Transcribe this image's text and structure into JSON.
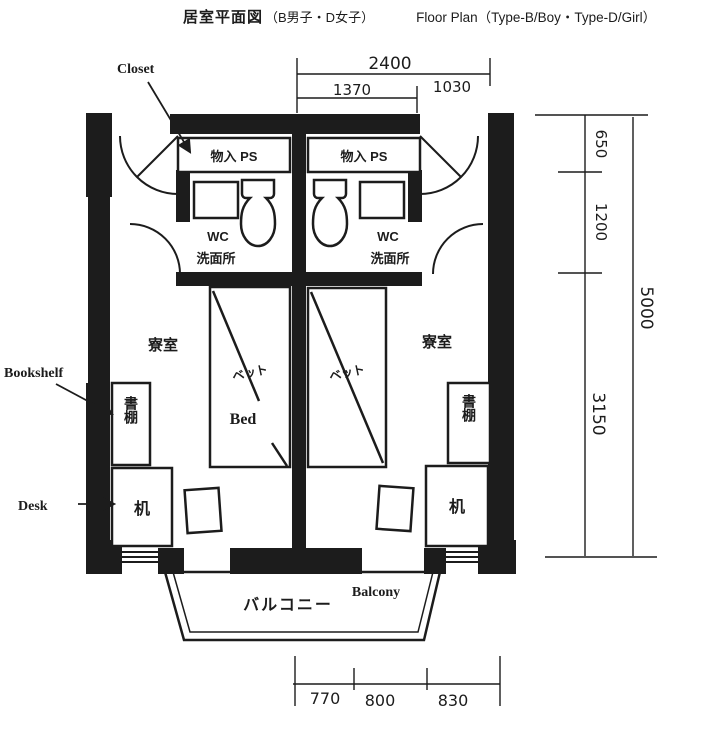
{
  "title": {
    "main": "居室平面図",
    "subtitle": "（B男子・D女子）",
    "english": "Floor Plan（Type-B/Boy・Type-D/Girl）"
  },
  "callouts": {
    "closet": "Closet",
    "bookshelf": "Bookshelf",
    "desk": "Desk"
  },
  "units": {
    "left": {
      "storage": "物入 PS",
      "wc": "WC",
      "washroom": "洗面所",
      "room": "寮室",
      "bed_jp": "ベット",
      "bed_en": "Bed",
      "bookshelf": "書棚",
      "desk": "机"
    },
    "right": {
      "storage": "物入 PS",
      "wc": "WC",
      "washroom": "洗面所",
      "room": "寮室",
      "bed_jp": "ベット",
      "bookshelf": "書棚",
      "desk": "机"
    }
  },
  "balcony": {
    "jp": "バルコニー",
    "en": "Balcony"
  },
  "dimensions_mm": {
    "top": {
      "overall": "2400",
      "segments": [
        "1370",
        "1030"
      ]
    },
    "right": {
      "segments": [
        "650",
        "1200",
        "3150"
      ],
      "overall": "5000"
    },
    "bottom": {
      "segments": [
        "770",
        "800",
        "830"
      ]
    }
  },
  "colors": {
    "ink": "#1c1c1c",
    "paper": "#ffffff"
  }
}
